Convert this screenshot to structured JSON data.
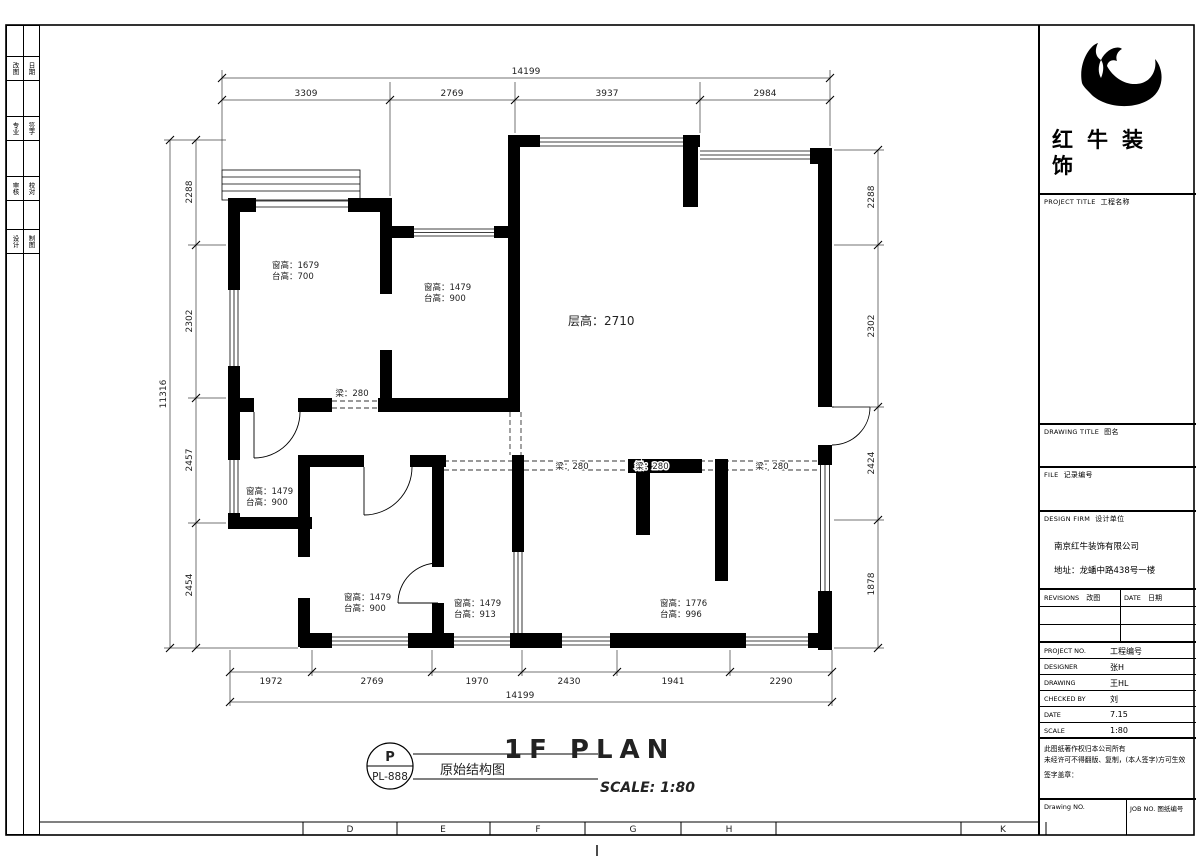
{
  "sheet": {
    "grid_letters": [
      "D",
      "E",
      "F",
      "G",
      "H",
      "K"
    ],
    "left_strip": [
      [
        "改图",
        "日期"
      ],
      [
        "专业",
        "签字"
      ],
      [
        "审核",
        "校对"
      ],
      [
        "设计",
        "制图"
      ]
    ]
  },
  "title_block": {
    "logo_line1": "红牛装",
    "logo_line2": "饰",
    "project_title_label": "PROJECT TITLE",
    "project_title_cn": "工程名称",
    "drawing_title_label": "DRAWING TITLE",
    "drawing_title_cn": "图名",
    "file_label": "FILE",
    "file_cn": "记录编号",
    "design_firm_label": "DESIGN FIRM",
    "design_firm_cn": "设计单位",
    "company_name": "南京红牛装饰有限公司",
    "company_address": "地址：龙蟠中路438号一楼",
    "revisions_label": "REVISIONS",
    "revisions_cn": "改图",
    "date_col_label": "DATE",
    "date_col_cn": "日期",
    "rows": [
      {
        "label": "PROJECT NO.",
        "value": "工程编号"
      },
      {
        "label": "DESIGNER",
        "value": "张H"
      },
      {
        "label": "DRAWING",
        "value": "王HL"
      },
      {
        "label": "CHECKED BY",
        "value": "刘"
      },
      {
        "label": "DATE",
        "value": "7.15"
      },
      {
        "label": "SCALE",
        "value": "1:80"
      }
    ],
    "notes": [
      "此图纸著作权归本公司所有",
      "未经许可不得翻版、复制，(本人签字)方可生效",
      "签字盖章："
    ],
    "drawing_no_label": "Drawing NO.",
    "job_no_label": "JOB NO. 图纸编号"
  },
  "footer": {
    "stamp_letter": "P",
    "stamp_code": "PL-888",
    "drawing_name": "原始结构图",
    "plan_title": "1F PLAN",
    "scale_text": "SCALE: 1:80"
  },
  "plan": {
    "floor_height": "层高：2710",
    "beams": [
      "梁：280",
      "梁：280",
      "梁：280",
      "梁：280"
    ],
    "rooms": [
      {
        "win": "窗高：1679",
        "sill": "台高：700"
      },
      {
        "win": "窗高：1479",
        "sill": "台高：900"
      },
      {
        "win": "窗高：1479",
        "sill": "台高：900"
      },
      {
        "win": "窗高：1479",
        "sill": "台高：900"
      },
      {
        "win": "窗高：1479",
        "sill": "台高：913"
      },
      {
        "win": "窗高：1776",
        "sill": "台高：996"
      }
    ],
    "dims": {
      "top_overall": "14199",
      "top": [
        "3309",
        "2769",
        "3937",
        "2984"
      ],
      "left_overall": "11316",
      "left": [
        "2288",
        "2302",
        "2457",
        "2454"
      ],
      "right": [
        "2288",
        "2302",
        "2424",
        "1878"
      ],
      "bottom": [
        "1972",
        "2769",
        "1970",
        "2430",
        "1941",
        "2290"
      ],
      "bottom_overall": "14199"
    }
  }
}
